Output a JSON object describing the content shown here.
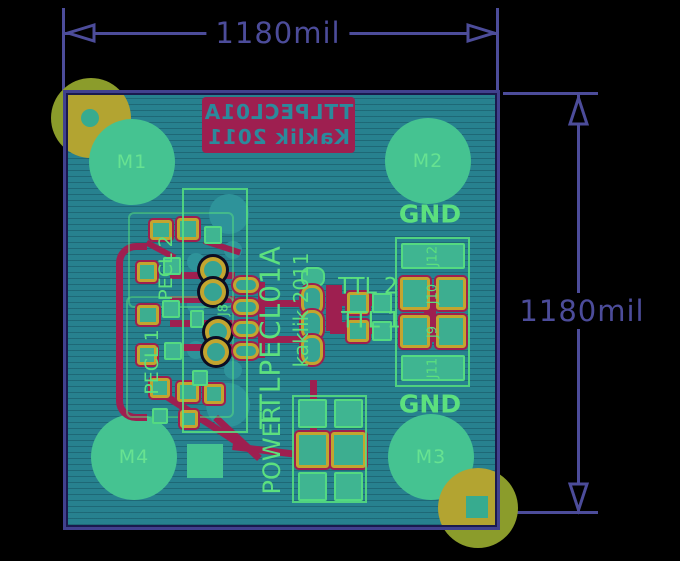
{
  "dimensions": {
    "top": {
      "label": "1180mil"
    },
    "right": {
      "label": "1180mil"
    }
  },
  "board": {
    "silkscreen_back": {
      "line1": "TTLPECL01A",
      "line2": "Kaklik 2011",
      "mirrored": true
    },
    "texts": {
      "title_vertical": "TTLPECL01A",
      "author_vertical": "kaklik 2011",
      "power": "POWER",
      "pecl1": "PECL 1",
      "pecl2": "PECL 2",
      "ttl1": "TTL 1",
      "ttl2": "TTL 2",
      "gnd_top": "GND",
      "gnd_bottom": "GND",
      "j8": "J8"
    },
    "mounting_holes": [
      {
        "label": "M1"
      },
      {
        "label": "M2"
      },
      {
        "label": "M3"
      },
      {
        "label": "M4"
      }
    ],
    "header_pins": [
      {
        "label": "J12"
      },
      {
        "label": "J10"
      },
      {
        "label": "J9"
      },
      {
        "label": "J11"
      }
    ],
    "colors": {
      "background": "#000000",
      "dimension": "#4C4C9A",
      "board_fill": "#27818F",
      "board_edge": "#41418E",
      "copper_green": "#45C391",
      "silk_green": "#5CE07E",
      "silk_red": "#9E1F50",
      "pad_yellow": "#C3A52F",
      "hole_olive": "#8B9C2B",
      "hole_mustard": "#B3A431"
    }
  }
}
